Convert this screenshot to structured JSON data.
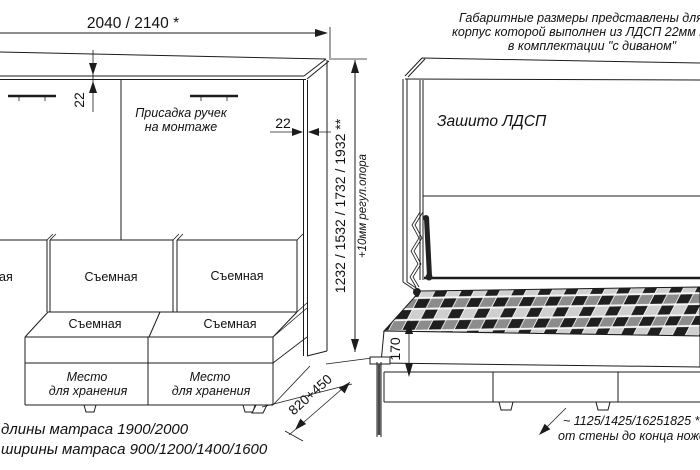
{
  "title_note": {
    "line1": "Габаритные размеры представлены для кров",
    "line2": "корпус которой выполнен из ЛДСП 22мм толщ",
    "line3": "в комплектации \"с диваном\""
  },
  "front_view": {
    "width_dim": "2040 / 2140 *",
    "top_panel_dim": "22",
    "side_panel_dim": "22",
    "handles_note_line1": "Присадка ручек",
    "handles_note_line2": "на монтаже",
    "back_cushion_left_fragment": "ая",
    "back_cushion_mid": "Съемная",
    "back_cushion_right": "Съемная",
    "seat_cushion_left": "Съемная",
    "seat_cushion_right": "Съемная",
    "storage_left_line1": "Место",
    "storage_left_line2": "для хранения",
    "storage_right_line1": "Место",
    "storage_right_line2": "для хранения",
    "depth_dim": "820+450"
  },
  "height_dim": {
    "value": "1232 / 1532 / 1732 / 1932 **",
    "note": "+10мм регул.опора"
  },
  "side_view": {
    "back_label": "Зашито ЛДСП",
    "platform_dim": "170",
    "wall_dim_line1": "~ 1125/1425/16251825 **",
    "wall_dim_line2": "от стены до конца ножек"
  },
  "footnotes": {
    "mattress_length": "длины матраса 1900/2000",
    "mattress_width": "ширины матраса 900/1200/1400/1600"
  }
}
